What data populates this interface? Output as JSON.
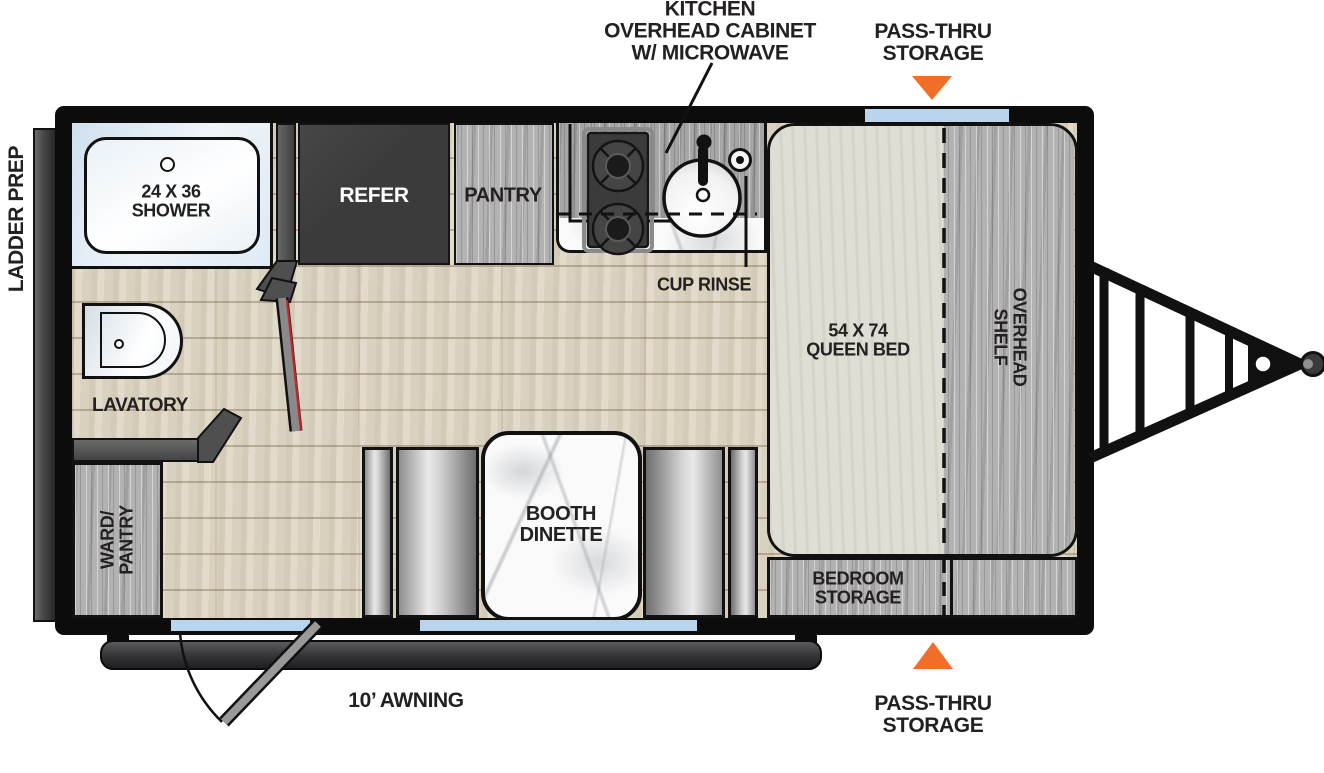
{
  "labels": {
    "kitchen_overhead": {
      "l1": "KITCHEN",
      "l2": "OVERHEAD CABINET",
      "l3": "W/ MICROWAVE"
    },
    "pass_thru_top": {
      "l1": "PASS-THRU",
      "l2": "STORAGE"
    },
    "pass_thru_bottom": {
      "l1": "PASS-THRU",
      "l2": "STORAGE"
    },
    "ladder_prep": "LADDER PREP",
    "awning": "10’ AWNING",
    "shower": {
      "l1": "24 X 36",
      "l2": "SHOWER"
    },
    "refer": "REFER",
    "pantry": "PANTRY",
    "cup_rinse": "CUP RINSE",
    "lavatory": "LAVATORY",
    "ward_pantry": {
      "l1": "WARD/",
      "l2": "PANTRY"
    },
    "queen_bed": {
      "l1": "54 X 74",
      "l2": "QUEEN BED"
    },
    "overhead_shelf": {
      "l1": "OVERHEAD",
      "l2": "SHELF"
    },
    "bedroom_storage": {
      "l1": "BEDROOM",
      "l2": "STORAGE"
    },
    "booth_dinette": {
      "l1": "BOOTH",
      "l2": "DINETTE"
    }
  },
  "colors": {
    "accent_orange": "#F06E27",
    "window_blue": "#BAD4EC",
    "wall_black": "#0C0C0C",
    "floor_wood": "#DDD6C6",
    "cabinet_gray_wood": "#B2B2B2",
    "refrigerator_dark": "#3B3B3B",
    "bed_beige": "#DFDDD4",
    "door_red": "#C1272D"
  }
}
